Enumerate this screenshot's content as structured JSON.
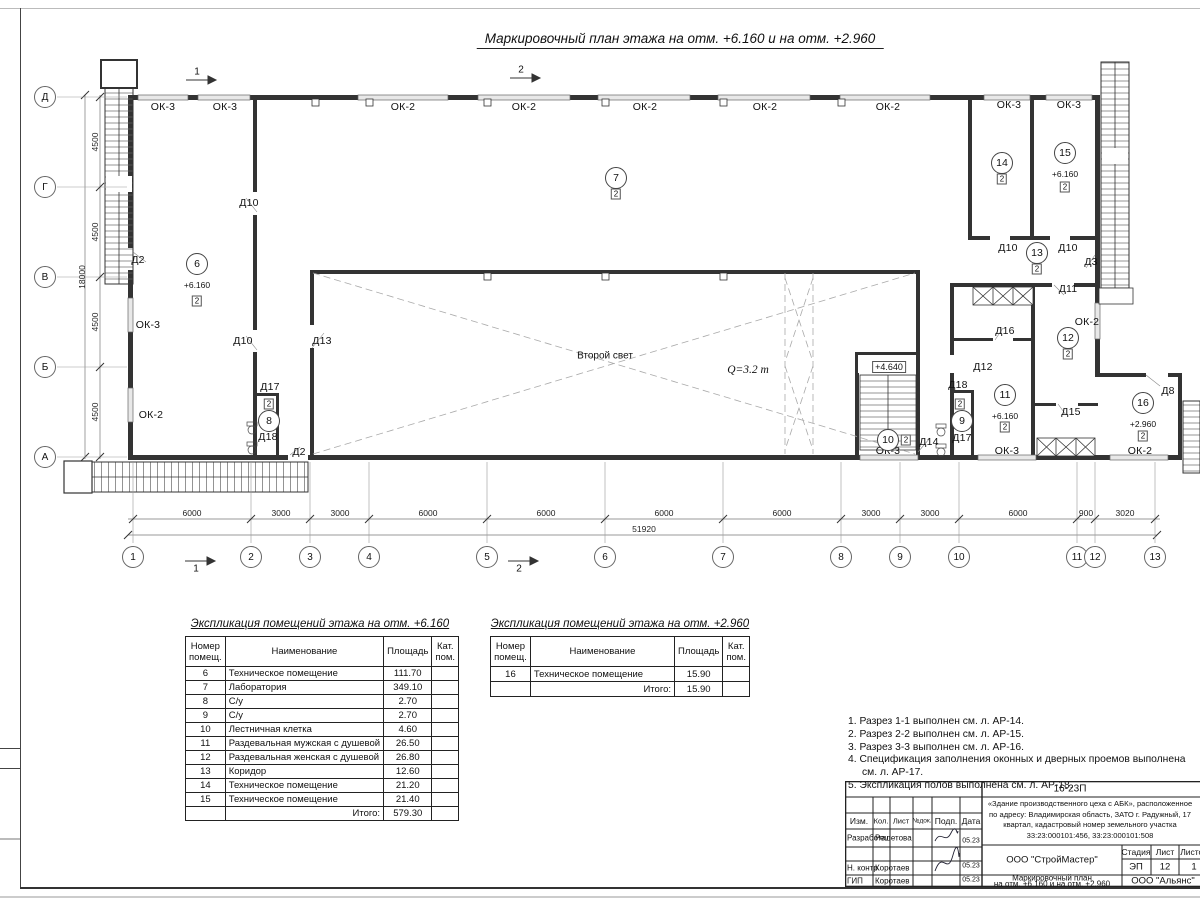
{
  "sheet": {
    "title": "Маркировочный план этажа на отм. +6.160 и на отм. +2.960"
  },
  "plan": {
    "axes_bottom": [
      {
        "label": "1",
        "x": 133
      },
      {
        "label": "2",
        "x": 251
      },
      {
        "label": "3",
        "x": 310
      },
      {
        "label": "4",
        "x": 369
      },
      {
        "label": "5",
        "x": 487
      },
      {
        "label": "6",
        "x": 605
      },
      {
        "label": "7",
        "x": 723
      },
      {
        "label": "8",
        "x": 841
      },
      {
        "label": "9",
        "x": 900
      },
      {
        "label": "10",
        "x": 959
      },
      {
        "label": "11",
        "x": 1077
      },
      {
        "label": "12",
        "x": 1095
      },
      {
        "label": "13",
        "x": 1155
      }
    ],
    "dims_bottom": [
      {
        "t": "6000",
        "x": 192
      },
      {
        "t": "3000",
        "x": 281
      },
      {
        "t": "3000",
        "x": 340
      },
      {
        "t": "6000",
        "x": 428
      },
      {
        "t": "6000",
        "x": 546
      },
      {
        "t": "6000",
        "x": 664
      },
      {
        "t": "6000",
        "x": 782
      },
      {
        "t": "3000",
        "x": 871
      },
      {
        "t": "3000",
        "x": 930
      },
      {
        "t": "6000",
        "x": 1018
      },
      {
        "t": "900",
        "x": 1086
      },
      {
        "t": "3020",
        "x": 1125
      }
    ],
    "total_bottom": {
      "t": "51920",
      "x": 644,
      "y": 529
    },
    "axes_left": [
      {
        "label": "Д",
        "y": 97
      },
      {
        "label": "Г",
        "y": 187
      },
      {
        "label": "В",
        "y": 277
      },
      {
        "label": "Б",
        "y": 367
      },
      {
        "label": "А",
        "y": 457
      }
    ],
    "dims_left": [
      {
        "t": "4500",
        "y": 142
      },
      {
        "t": "4500",
        "y": 232
      },
      {
        "t": "4500",
        "y": 322
      },
      {
        "t": "4500",
        "y": 412
      }
    ],
    "total_left": {
      "t": "18000",
      "x": 82,
      "y": 277
    },
    "window_labels": [
      {
        "t": "ОК-3",
        "x": 163,
        "y": 107
      },
      {
        "t": "ОК-3",
        "x": 225,
        "y": 107
      },
      {
        "t": "ОК-2",
        "x": 403,
        "y": 107
      },
      {
        "t": "ОК-2",
        "x": 524,
        "y": 107
      },
      {
        "t": "ОК-2",
        "x": 645,
        "y": 107
      },
      {
        "t": "ОК-2",
        "x": 765,
        "y": 107
      },
      {
        "t": "ОК-2",
        "x": 888,
        "y": 107
      },
      {
        "t": "ОК-3",
        "x": 1009,
        "y": 105
      },
      {
        "t": "ОК-3",
        "x": 1069,
        "y": 105
      },
      {
        "t": "ОК-3",
        "x": 148,
        "y": 325
      },
      {
        "t": "ОК-2",
        "x": 151,
        "y": 415
      },
      {
        "t": "ОК-3",
        "x": 888,
        "y": 451
      },
      {
        "t": "ОК-3",
        "x": 1007,
        "y": 451
      },
      {
        "t": "ОК-2",
        "x": 1140,
        "y": 451
      },
      {
        "t": "ОК-2",
        "x": 1087,
        "y": 322
      }
    ],
    "door_labels": [
      {
        "t": "Д2",
        "x": 138,
        "y": 260
      },
      {
        "t": "Д10",
        "x": 249,
        "y": 203
      },
      {
        "t": "Д10",
        "x": 243,
        "y": 341
      },
      {
        "t": "Д13",
        "x": 322,
        "y": 341
      },
      {
        "t": "Д17",
        "x": 270,
        "y": 387
      },
      {
        "t": "Д18",
        "x": 268,
        "y": 437
      },
      {
        "t": "Д2",
        "x": 299,
        "y": 452
      },
      {
        "t": "Д14",
        "x": 929,
        "y": 442
      },
      {
        "t": "Д18",
        "x": 958,
        "y": 385
      },
      {
        "t": "Д17",
        "x": 962,
        "y": 438
      },
      {
        "t": "Д12",
        "x": 983,
        "y": 367
      },
      {
        "t": "Д16",
        "x": 1005,
        "y": 331
      },
      {
        "t": "Д11",
        "x": 1068,
        "y": 289
      },
      {
        "t": "Д15",
        "x": 1071,
        "y": 412
      },
      {
        "t": "Д3",
        "x": 1091,
        "y": 262
      },
      {
        "t": "Д10",
        "x": 1008,
        "y": 248
      },
      {
        "t": "Д10",
        "x": 1068,
        "y": 248
      },
      {
        "t": "Д8",
        "x": 1168,
        "y": 391
      }
    ],
    "rooms": [
      {
        "n": "6",
        "x": 197,
        "y": 264,
        "elev": "+6.160"
      },
      {
        "n": "7",
        "x": 616,
        "y": 178
      },
      {
        "n": "8",
        "x": 269,
        "y": 421
      },
      {
        "n": "9",
        "x": 962,
        "y": 421
      },
      {
        "n": "10",
        "x": 888,
        "y": 440
      },
      {
        "n": "11",
        "x": 1005,
        "y": 395,
        "elev": "+6.160"
      },
      {
        "n": "12",
        "x": 1068,
        "y": 338
      },
      {
        "n": "13",
        "x": 1037,
        "y": 253
      },
      {
        "n": "14",
        "x": 1002,
        "y": 163
      },
      {
        "n": "15",
        "x": 1065,
        "y": 153,
        "elev": "+6.160"
      },
      {
        "n": "16",
        "x": 1143,
        "y": 403,
        "elev": "+2.960"
      }
    ],
    "cat_boxes": [
      {
        "t": "2",
        "x": 197,
        "y": 301
      },
      {
        "t": "2",
        "x": 616,
        "y": 194
      },
      {
        "t": "2",
        "x": 269,
        "y": 404
      },
      {
        "t": "2",
        "x": 960,
        "y": 404
      },
      {
        "t": "2",
        "x": 906,
        "y": 440
      },
      {
        "t": "2",
        "x": 1005,
        "y": 427
      },
      {
        "t": "2",
        "x": 1068,
        "y": 354
      },
      {
        "t": "2",
        "x": 1037,
        "y": 269
      },
      {
        "t": "2",
        "x": 1002,
        "y": 179
      },
      {
        "t": "2",
        "x": 1065,
        "y": 187
      },
      {
        "t": "2",
        "x": 1143,
        "y": 436
      }
    ],
    "texts": [
      {
        "t": "Второй свет",
        "x": 605,
        "y": 356,
        "s": "plain"
      },
      {
        "t": "Q=3.2 т",
        "x": 748,
        "y": 370,
        "s": "italic"
      },
      {
        "t": "+4.640",
        "x": 889,
        "y": 367,
        "s": "boxed"
      }
    ],
    "section_marks": [
      {
        "t": "1",
        "x": 197,
        "y": 72
      },
      {
        "t": "2",
        "x": 521,
        "y": 70
      },
      {
        "t": "1",
        "x": 196,
        "y": 569
      },
      {
        "t": "2",
        "x": 519,
        "y": 569
      }
    ]
  },
  "tables": [
    {
      "title": "Экспликация помещений этажа на отм. +6.160",
      "headers": [
        "Номер помещ.",
        "Наименование",
        "Площадь",
        "Кат. пом."
      ],
      "rows": [
        [
          "6",
          "Техническое помещение",
          "111.70",
          ""
        ],
        [
          "7",
          "Лаборатория",
          "349.10",
          ""
        ],
        [
          "8",
          "С/у",
          "2.70",
          ""
        ],
        [
          "9",
          "С/у",
          "2.70",
          ""
        ],
        [
          "10",
          "Лестничная клетка",
          "4.60",
          ""
        ],
        [
          "11",
          "Раздевальная мужская с душевой",
          "26.50",
          ""
        ],
        [
          "12",
          "Раздевальная женская с душевой",
          "26.80",
          ""
        ],
        [
          "13",
          "Коридор",
          "12.60",
          ""
        ],
        [
          "14",
          "Техническое помещение",
          "21.20",
          ""
        ],
        [
          "15",
          "Техническое помещение",
          "21.40",
          ""
        ]
      ],
      "total_label": "Итого:",
      "total_value": "579.30"
    },
    {
      "title": "Экспликация помещений этажа на отм. +2.960",
      "headers": [
        "Номер помещ.",
        "Наименование",
        "Площадь",
        "Кат. пом."
      ],
      "rows": [
        [
          "16",
          "Техническое помещение",
          "15.90",
          ""
        ]
      ],
      "total_label": "Итого:",
      "total_value": "15.90"
    }
  ],
  "notes": [
    "1. Разрез 1-1 выполнен см. л. АР-14.",
    "2. Разрез 2-2 выполнен см. л. АР-15.",
    "3. Разрез 3-3 выполнен см. л. АР-16.",
    "4. Спецификация заполнения оконных и дверных проемов выполнена см. л. АР-17.",
    "5. Экспликация полов выполнена см. л. АР-18."
  ],
  "titleblock": {
    "code": "16-23П",
    "project": "«Здание производственного цеха с АБК», расположенное по адресу: Владимирская область, ЗАТО г. Радужный, 17 квартал, кадастровый номер земельного участка 33:23:000101:456, 33:23:000101:508",
    "header_cols": [
      "Изм.",
      "Кол.",
      "Лист",
      "№док.",
      "Подп.",
      "Дата"
    ],
    "staff": [
      {
        "role": "Разработал",
        "name": "Решетова",
        "date": "05.23"
      },
      {
        "role": "Н. контр.",
        "name": "Коротаев",
        "date": "05.23"
      },
      {
        "role": "ГИП",
        "name": "Коротаев",
        "date": "05.23"
      }
    ],
    "org": "ООО \"СтройМастер\"",
    "stage_cols": [
      "Стадия",
      "Лист",
      "Листов"
    ],
    "stage": "ЭП",
    "sheet_no": "12",
    "sheets_total": "1",
    "doc_title1": "Маркировочный план",
    "doc_title2": "на отм. +6.160 и на отм. +2.960",
    "org2": "ООО \"Альянс\""
  }
}
